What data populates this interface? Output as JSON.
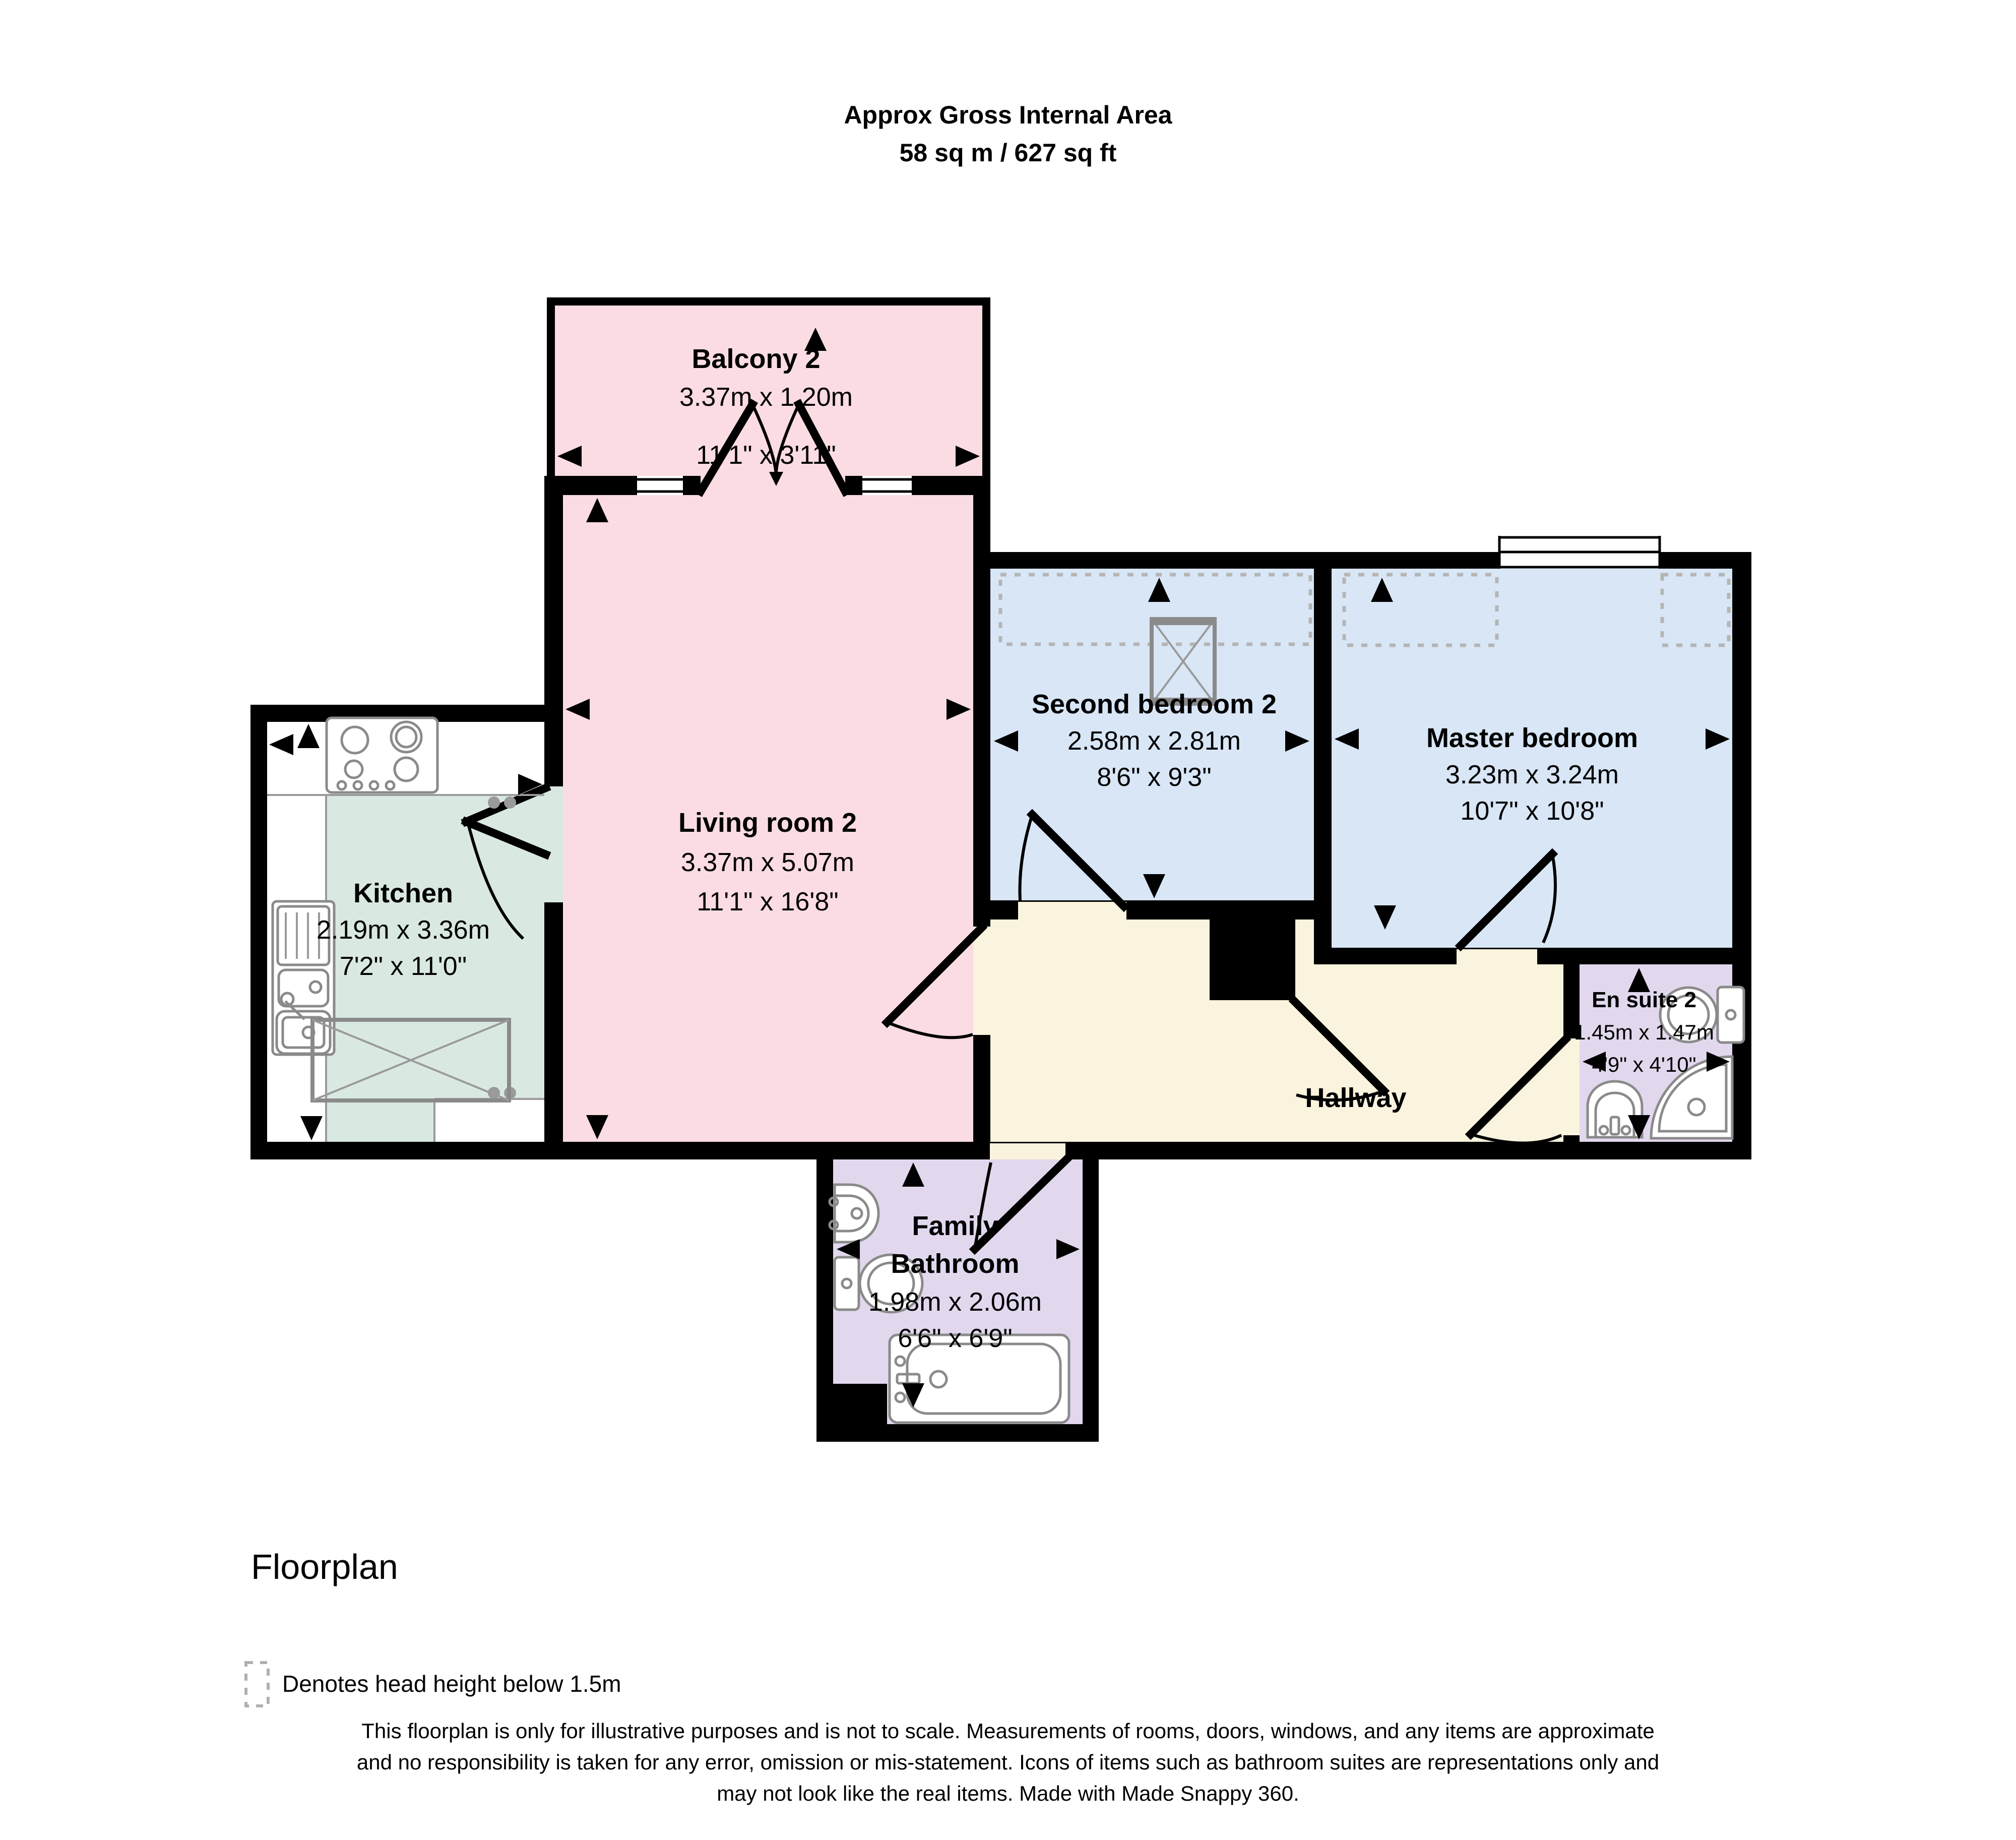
{
  "header": {
    "line1": "Approx Gross Internal Area",
    "line2": "58 sq m / 627 sq ft"
  },
  "rooms": {
    "balcony": {
      "name": "Balcony 2",
      "metric": "3.37m x 1.20m",
      "imperial": "11'1\" x 3'11\""
    },
    "living": {
      "name": "Living room 2",
      "metric": "3.37m x 5.07m",
      "imperial": "11'1\" x 16'8\""
    },
    "kitchen": {
      "name": "Kitchen",
      "metric": "2.19m x 3.36m",
      "imperial": "7'2\" x 11'0\""
    },
    "second_bedroom": {
      "name": "Second bedroom 2",
      "metric": "2.58m x 2.81m",
      "imperial": "8'6\" x 9'3\""
    },
    "master_bedroom": {
      "name": "Master bedroom",
      "metric": "3.23m x 3.24m",
      "imperial": "10'7\" x 10'8\""
    },
    "en_suite": {
      "name": "En suite 2",
      "metric": "1.45m x 1.47m",
      "imperial": "4'9\" x 4'10\""
    },
    "hallway": {
      "name": "Hallway"
    },
    "family_bathroom": {
      "name_line1": "Family",
      "name_line2": "Bathroom",
      "metric": "1.98m x 2.06m",
      "imperial": "6'6\" x 6'9\""
    }
  },
  "footer": {
    "caption": "Floorplan",
    "legend": "Denotes head height below 1.5m",
    "disclaimer1": "This floorplan is only for illustrative purposes and is not to scale. Measurements of rooms, doors, windows, and any items are approximate",
    "disclaimer2": "and no responsibility is taken for any error, omission or mis-statement. Icons of items such as bathroom suites are representations only and",
    "disclaimer3": "may not look like the real items. Made with Made Snappy 360."
  },
  "colors": {
    "wall": "#000000",
    "balcony": "#fadce2",
    "living": "#fadce2",
    "kitchen": "#d9e9e1",
    "bedroom": "#d8e6f6",
    "hallway": "#faf3dd",
    "bathroom": "#e2d8ee",
    "head_height_dash": "#b5b5b5",
    "fixture_stroke": "#8a8a8a"
  }
}
